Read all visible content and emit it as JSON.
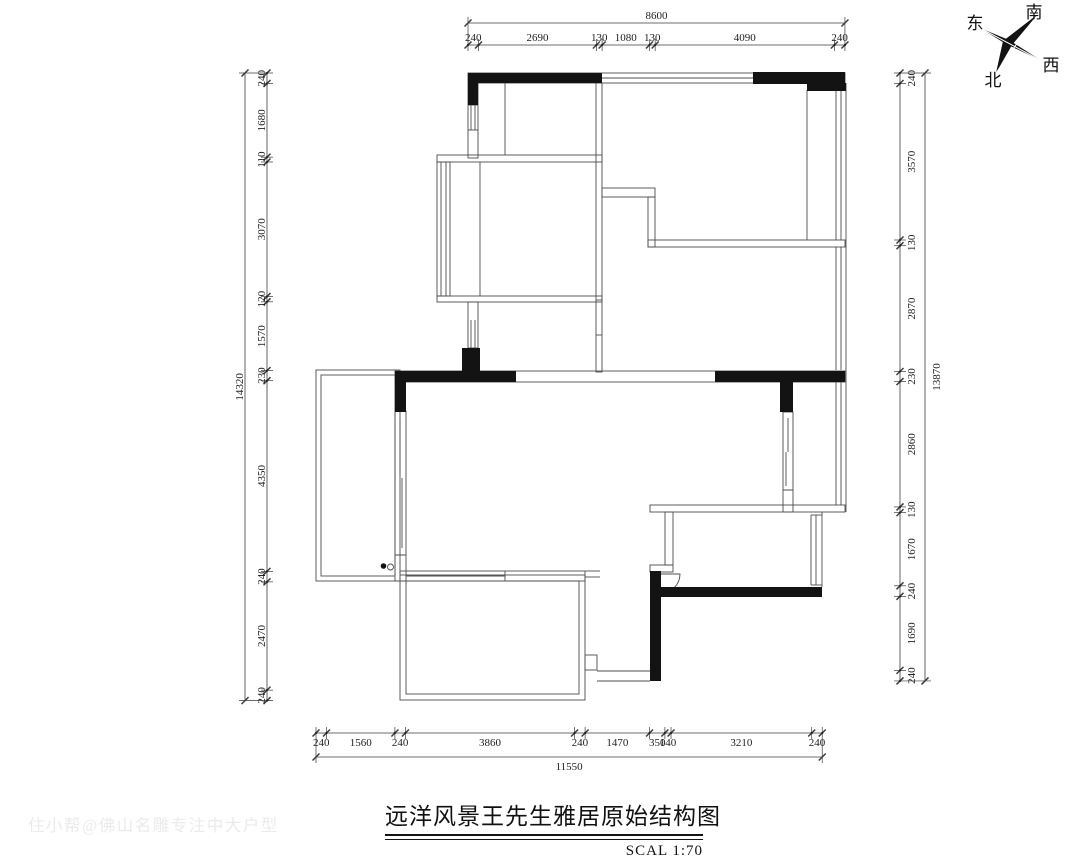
{
  "title": {
    "text": "远洋风景王先生雅居原始结构图",
    "scale_label": "SCAL 1:70"
  },
  "watermark": {
    "text": "住小帮@佛山名雕专注中大户型"
  },
  "compass": {
    "east": "东",
    "south": "南",
    "west": "西",
    "north": "北"
  },
  "dimensions": {
    "top": {
      "total": "8600",
      "segments": [
        240,
        2690,
        130,
        1080,
        130,
        4090,
        240
      ]
    },
    "bottom": {
      "total": "11550",
      "segments": [
        240,
        1560,
        240,
        3860,
        240,
        1470,
        350,
        140,
        3210,
        240
      ]
    },
    "left": {
      "total": "14320",
      "segments": [
        240,
        1680,
        110,
        3070,
        120,
        1570,
        230,
        4350,
        240,
        2470,
        240
      ]
    },
    "right": {
      "total": "13870",
      "segments": [
        240,
        3570,
        130,
        2870,
        230,
        2860,
        130,
        1670,
        240,
        1690,
        240
      ]
    }
  },
  "colors": {
    "wall_fill": "#131313",
    "line": "#4d4d4d",
    "dim_text": "#222222",
    "watermark": "#ebebeb"
  }
}
